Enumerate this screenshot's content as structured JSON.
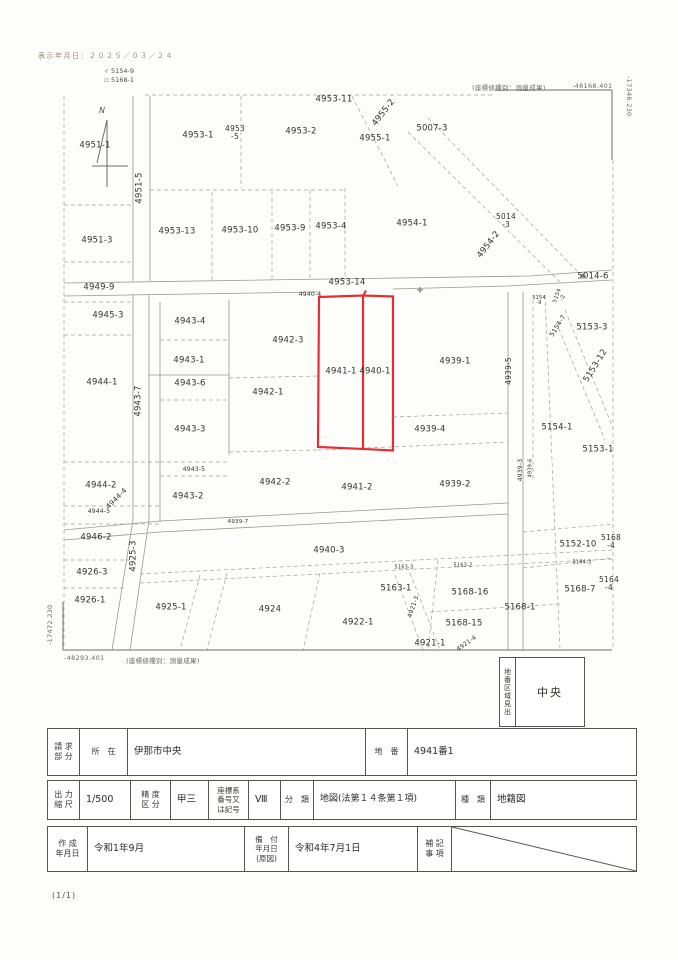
{
  "page": {
    "print_date": "表示年月日：２０２５／０３／２４",
    "page_number": "(1/1)",
    "north_label": "N"
  },
  "map": {
    "highlight_color": "#e23030",
    "refs": [
      {
        "mark": "イ",
        "no": "5154-9"
      },
      {
        "mark": "ロ",
        "no": "5168-1"
      }
    ],
    "coords": {
      "top_right_type": "(座標値種別：測量成果)",
      "top_right_value": "-48168.401",
      "right_edge_value": "-17346.230",
      "left_edge_value": "-17472.230",
      "bottom_left_value": "-48293.401",
      "bottom_left_type": "(座標値種別：測量成果)"
    },
    "highlighted_parcels": [
      "4941-1",
      "4940-1"
    ],
    "parcels": [
      {
        "t": "4953-11",
        "x": 334,
        "y": 100
      },
      {
        "t": "4955-2",
        "x": 384,
        "y": 113,
        "r": -52
      },
      {
        "t": "4953-1",
        "x": 198,
        "y": 136
      },
      {
        "t": "4953\n-5",
        "x": 235,
        "y": 133,
        "s": 7.5
      },
      {
        "t": "4953-2",
        "x": 301,
        "y": 132
      },
      {
        "t": "4955-1",
        "x": 375,
        "y": 139
      },
      {
        "t": "5007-3",
        "x": 432,
        "y": 129
      },
      {
        "t": "4951-1",
        "x": 95,
        "y": 146
      },
      {
        "t": "4951-5",
        "x": 140,
        "y": 188,
        "r": -90
      },
      {
        "t": "4953-13",
        "x": 177,
        "y": 232
      },
      {
        "t": "4953-10",
        "x": 240,
        "y": 231
      },
      {
        "t": "4953-9",
        "x": 290,
        "y": 229
      },
      {
        "t": "4953-4",
        "x": 331,
        "y": 227
      },
      {
        "t": "4954-1",
        "x": 412,
        "y": 224
      },
      {
        "t": "5014\n-3",
        "x": 506,
        "y": 221,
        "s": 7.5
      },
      {
        "t": "4954-2",
        "x": 489,
        "y": 245,
        "r": -52
      },
      {
        "t": "4951-3",
        "x": 97,
        "y": 241
      },
      {
        "t": "5014-6",
        "x": 593,
        "y": 277
      },
      {
        "t": "4949-9",
        "x": 99,
        "y": 288
      },
      {
        "t": "4953-14",
        "x": 347,
        "y": 283
      },
      {
        "t": "4940-4",
        "x": 310,
        "y": 295,
        "s": 6
      },
      {
        "t": "5154\n-2",
        "x": 561,
        "y": 297,
        "r": -70,
        "s": 5.5
      },
      {
        "t": "5154\n-9",
        "x": 539,
        "y": 301,
        "s": 5
      },
      {
        "t": "5154-7",
        "x": 558,
        "y": 326,
        "r": -58,
        "s": 6.5
      },
      {
        "t": "5153-3",
        "x": 592,
        "y": 328
      },
      {
        "t": "4945-3",
        "x": 108,
        "y": 316
      },
      {
        "t": "4943-4",
        "x": 190,
        "y": 322
      },
      {
        "t": "4942-3",
        "x": 288,
        "y": 341
      },
      {
        "t": "5153-12",
        "x": 596,
        "y": 366,
        "r": -58
      },
      {
        "t": "4943-1",
        "x": 189,
        "y": 361
      },
      {
        "t": "4941-1",
        "x": 341,
        "y": 372
      },
      {
        "t": "4940-1",
        "x": 375,
        "y": 372
      },
      {
        "t": "4939-1",
        "x": 455,
        "y": 362
      },
      {
        "t": "4939-5",
        "x": 509,
        "y": 371,
        "r": -90,
        "s": 7.5
      },
      {
        "t": "4944-1",
        "x": 102,
        "y": 383
      },
      {
        "t": "4943-7",
        "x": 139,
        "y": 401,
        "r": -90
      },
      {
        "t": "4943-6",
        "x": 190,
        "y": 384
      },
      {
        "t": "4942-1",
        "x": 268,
        "y": 393
      },
      {
        "t": "4943-3",
        "x": 190,
        "y": 430
      },
      {
        "t": "4939-4",
        "x": 430,
        "y": 430
      },
      {
        "t": "5154-1",
        "x": 557,
        "y": 428
      },
      {
        "t": "5153-1",
        "x": 598,
        "y": 450
      },
      {
        "t": "4939-3",
        "x": 521,
        "y": 470,
        "r": -90,
        "s": 6
      },
      {
        "t": "4939-6",
        "x": 531,
        "y": 468,
        "r": -90,
        "s": 5
      },
      {
        "t": "4943-5",
        "x": 194,
        "y": 470,
        "s": 6
      },
      {
        "t": "4944-2",
        "x": 101,
        "y": 486
      },
      {
        "t": "4944-4",
        "x": 117,
        "y": 499,
        "r": -45,
        "s": 7
      },
      {
        "t": "4942-2",
        "x": 275,
        "y": 483
      },
      {
        "t": "4941-2",
        "x": 357,
        "y": 488
      },
      {
        "t": "4939-2",
        "x": 455,
        "y": 485
      },
      {
        "t": "4944-5",
        "x": 99,
        "y": 512,
        "s": 6
      },
      {
        "t": "4943-2",
        "x": 188,
        "y": 497
      },
      {
        "t": "4939-7",
        "x": 238,
        "y": 523,
        "s": 5.5
      },
      {
        "t": "4946-2",
        "x": 96,
        "y": 538
      },
      {
        "t": "4925-3",
        "x": 134,
        "y": 556,
        "r": -90
      },
      {
        "t": "4940-3",
        "x": 329,
        "y": 551
      },
      {
        "t": "5152-10",
        "x": 578,
        "y": 545
      },
      {
        "t": "5168\n-4",
        "x": 611,
        "y": 542,
        "s": 7.5
      },
      {
        "t": "4926-3",
        "x": 92,
        "y": 573
      },
      {
        "t": "5163-3",
        "x": 404,
        "y": 568,
        "s": 5
      },
      {
        "t": "5163-2",
        "x": 463,
        "y": 566,
        "s": 5
      },
      {
        "t": "5164-3",
        "x": 582,
        "y": 563,
        "s": 5
      },
      {
        "t": "5164\n-4",
        "x": 609,
        "y": 584,
        "s": 7.5
      },
      {
        "t": "5163-1",
        "x": 396,
        "y": 589
      },
      {
        "t": "5168-7",
        "x": 580,
        "y": 590
      },
      {
        "t": "5168-16",
        "x": 470,
        "y": 593
      },
      {
        "t": "4926-1",
        "x": 90,
        "y": 601
      },
      {
        "t": "4921-3",
        "x": 414,
        "y": 607,
        "r": -70,
        "s": 6
      },
      {
        "t": "5168-1",
        "x": 520,
        "y": 608
      },
      {
        "t": "4925-1",
        "x": 171,
        "y": 608
      },
      {
        "t": "4924",
        "x": 270,
        "y": 610
      },
      {
        "t": "4922-1",
        "x": 358,
        "y": 623
      },
      {
        "t": "5168-15",
        "x": 464,
        "y": 624
      },
      {
        "t": "4921-1",
        "x": 430,
        "y": 644
      },
      {
        "t": "4921-4",
        "x": 467,
        "y": 644,
        "r": -35,
        "s": 6
      }
    ]
  },
  "legend_box": {
    "title": "地番区域見出",
    "value": "中央"
  },
  "table": {
    "row1": {
      "h_request": "請 求\n部 分",
      "h_location": "所　在",
      "v_location": "伊那市中央",
      "h_lot": "地　番",
      "v_lot": "4941番1"
    },
    "row2": {
      "h_scale": "出 力\n縮 尺",
      "v_scale": "1/500",
      "h_precision": "精 度\n区 分",
      "v_precision": "甲三",
      "h_coordsys": "座標系\n番号又\nは記号",
      "v_coordsys": "Ⅷ",
      "h_class": "分　類",
      "v_class": "地図(法第１４条第１項)",
      "h_kind": "種　類",
      "v_kind": "地籍図"
    },
    "row3": {
      "h_created": "作 成\n年月日",
      "v_created": "令和1年9月",
      "h_filed": "備　付\n年月日\n(原図)",
      "v_filed": "令和4年7月1日",
      "h_note": "補 記\n事 項"
    }
  }
}
